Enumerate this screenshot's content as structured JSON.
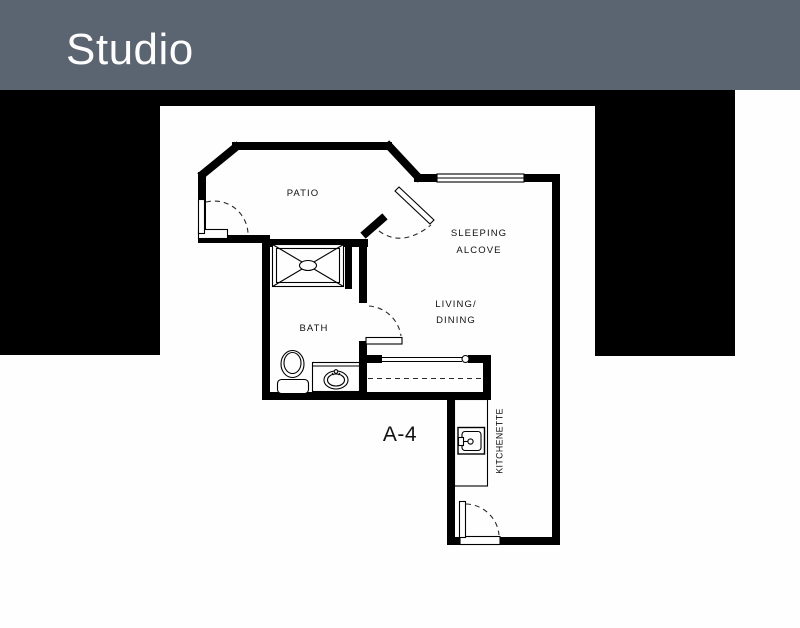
{
  "header": {
    "title": "Studio",
    "background_color": "#5b6471",
    "text_color": "#fdfdfd"
  },
  "floor_plan": {
    "unit_label": "A-4",
    "rooms": [
      {
        "id": "patio",
        "label": "PATIO"
      },
      {
        "id": "sleeping-alcove",
        "lines": [
          "SLEEPING",
          "ALCOVE"
        ]
      },
      {
        "id": "living-dining",
        "lines": [
          "LIVING/",
          "DINING"
        ]
      },
      {
        "id": "bath",
        "label": "BATH"
      },
      {
        "id": "kitchenette",
        "label": "KITCHENETTE"
      }
    ],
    "fixtures": [
      "shower",
      "toilet",
      "vanity-sink",
      "kitchen-sink",
      "entry-door",
      "patio-door",
      "bath-door",
      "alcove-door",
      "window"
    ],
    "colors": {
      "wall": "#000000",
      "mask": "#020202",
      "paper": "#fefefe",
      "line": "#111111"
    }
  }
}
